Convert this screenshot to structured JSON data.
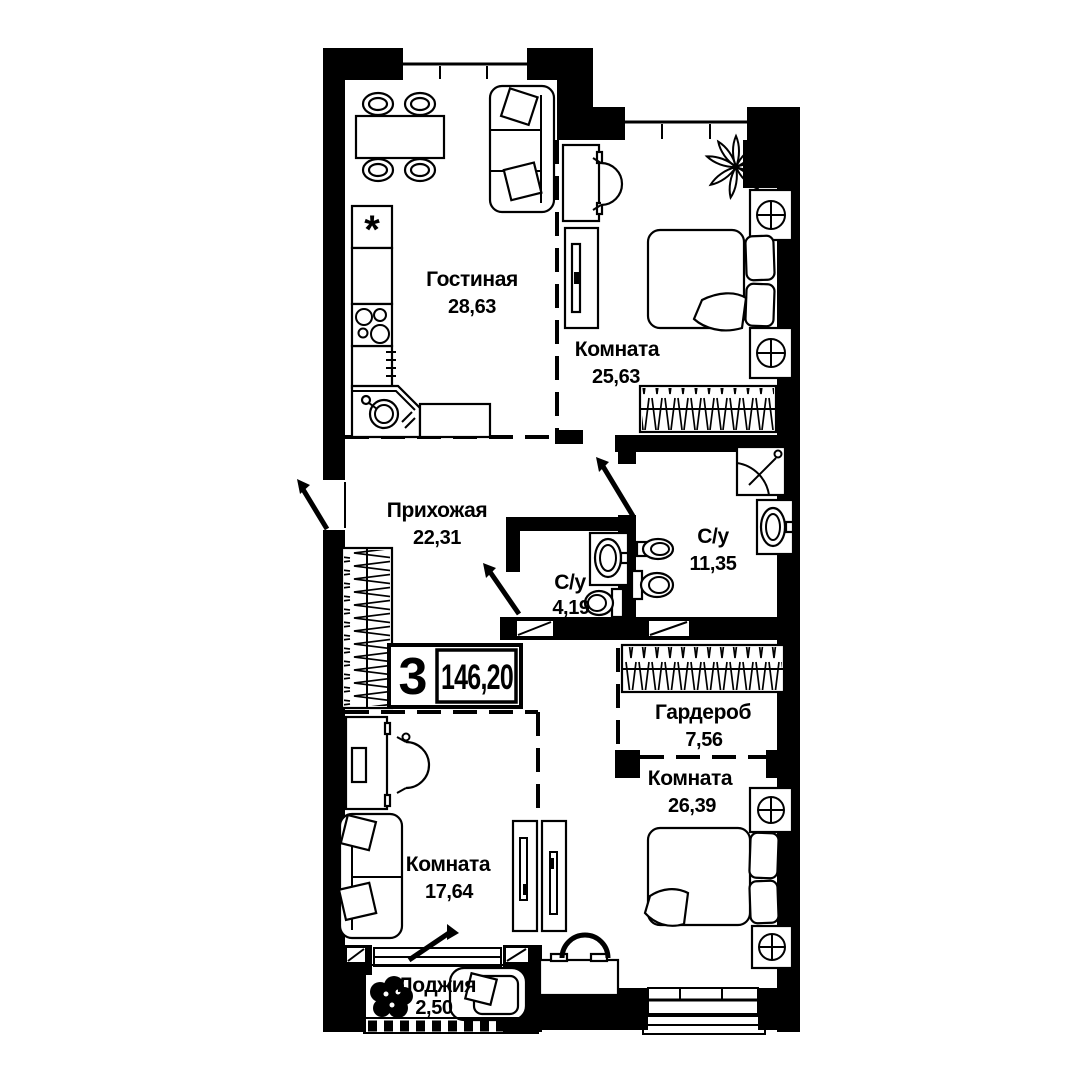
{
  "plan": {
    "kind": "apartment-floor-plan",
    "badge": {
      "rooms_count": "3",
      "total_area": "146,20"
    },
    "rooms": [
      {
        "key": "living",
        "name": "Гостиная",
        "area": "28,63"
      },
      {
        "key": "bedroom_top",
        "name": "Комната",
        "area": "25,63"
      },
      {
        "key": "hallway",
        "name": "Прихожая",
        "area": "22,31"
      },
      {
        "key": "bath_small",
        "name": "С/у",
        "area": "4,19"
      },
      {
        "key": "bath_big",
        "name": "С/у",
        "area": "11,35"
      },
      {
        "key": "wardrobe_room",
        "name": "Гардероб",
        "area": "7,56"
      },
      {
        "key": "bedroom_right",
        "name": "Комната",
        "area": "26,39"
      },
      {
        "key": "bedroom_left",
        "name": "Комната",
        "area": "17,64"
      },
      {
        "key": "loggia",
        "name": "Лоджия",
        "area": "2,50"
      }
    ],
    "fridge_glyph": "*",
    "colors": {
      "wall": "#000000",
      "background": "#ffffff",
      "line": "#000000"
    }
  }
}
